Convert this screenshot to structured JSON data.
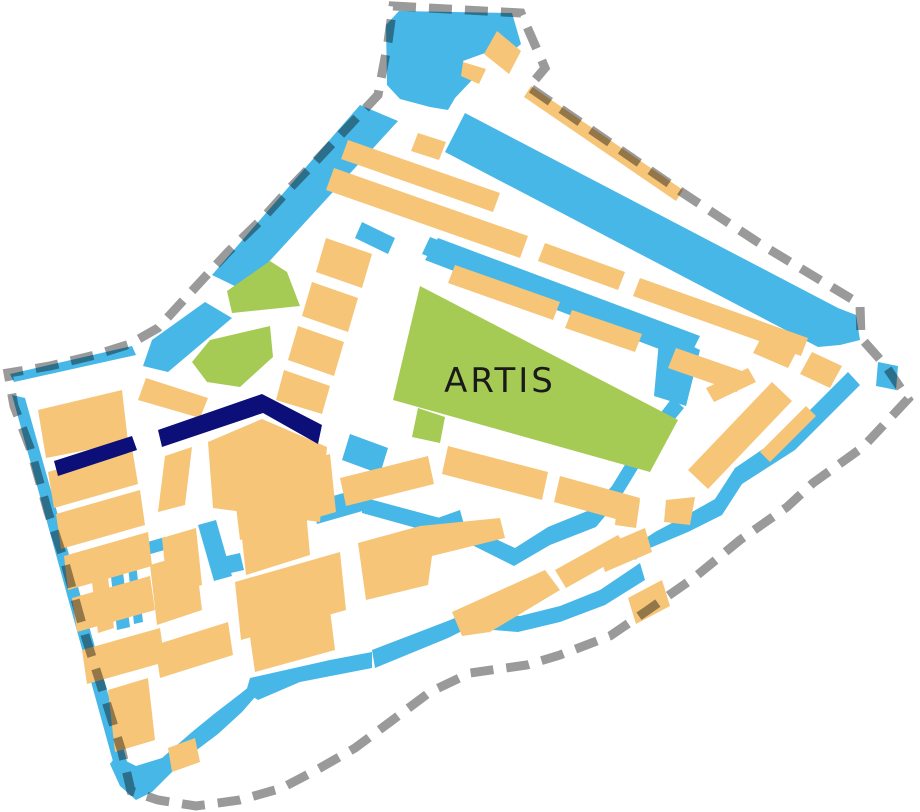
{
  "map": {
    "title_label": "ARTIS",
    "label_position": {
      "x": 500,
      "y": 392
    },
    "palette": {
      "background": "#FFFFFF",
      "water": "#47B7E7",
      "block": "#F6C577",
      "park": "#A6CB55",
      "highlight": "#0C0F78",
      "boundary": "#9A9A9A",
      "label": "#1A1A1A"
    },
    "boundary": {
      "name": "district-boundary",
      "stroke_width": 9,
      "dash": "23 13",
      "path": "M393,6 L521,13 L545,68 L529,87 L683,193 L762,245 L860,304 L861,338 L885,365 L908,399 L863,447 L813,483 L787,507 L740,540 L695,577 L648,610 L610,636 L560,655 L527,665 L470,673 L430,692 L390,722 L355,748 L320,768 L282,788 L240,800 L196,806 L158,800 L131,791 L122,752 L104,695 L85,635 L65,563 L48,512 L30,448 L14,406 L8,373 L50,366 L95,355 L130,344 L158,328 L180,304 L204,278 L228,252 L262,219 L292,186 L315,162 L348,127 L378,95 L388,42 Z"
    },
    "shapes": [
      {
        "name": "harbor-water",
        "type": "water",
        "points": "399,11 512,13 521,44 501,61 485,53 463,61 472,80 455,98 448,110 430,107 400,99 387,85 386,25"
      },
      {
        "name": "nw-canal-upper",
        "type": "water",
        "points": "360,105 398,121 243,290 212,275"
      },
      {
        "name": "nw-canal-lower",
        "type": "water",
        "points": "205,302 232,318 168,372 143,366 152,340"
      },
      {
        "name": "west-boundary-canal-top",
        "type": "water",
        "points": "10,374 132,346 136,355 14,382"
      },
      {
        "name": "west-boundary-canal",
        "type": "water",
        "points": "12,395 25,398 130,772 117,776"
      },
      {
        "name": "southwest-canal-bend",
        "type": "water",
        "points": "116,756 136,766 162,758 192,732 214,714 240,694 250,686 256,696 242,712 218,734 194,752 170,774 152,792 136,800 120,786 110,764"
      },
      {
        "name": "entrepotdok-canal",
        "type": "water",
        "points": "465,113 838,308 856,315 860,340 840,345 818,347 445,152"
      },
      {
        "name": "boundary-water-patch",
        "type": "water",
        "points": "878,362 898,366 896,390 876,386"
      },
      {
        "name": "middle-canal",
        "type": "water",
        "points": "438,238 700,336 688,360 425,260"
      },
      {
        "name": "artis-east-canal",
        "type": "water",
        "points": "660,330 700,350 686,406 654,396"
      },
      {
        "name": "artis-south-canal",
        "type": "water",
        "points": "672,398 640,440 612,486 590,510 548,527 515,548 470,527 440,518 362,497 362,513 438,534 468,543 514,566 550,545 596,527 620,498 648,452 684,408"
      },
      {
        "name": "southeast-boundary-canal",
        "type": "water",
        "points": "860,385 795,450 742,484 722,515 688,532 650,548 635,560 640,542 655,532 685,516 715,499 735,468 788,432 848,372"
      },
      {
        "name": "south-canal",
        "type": "water",
        "points": "372,650 445,622 470,612 520,616 560,606 600,590 640,563 645,580 605,605 560,622 518,632 468,628 448,638 375,668"
      },
      {
        "name": "south-canal-west",
        "type": "water",
        "points": "246,692 250,678 330,660 372,652 372,668 300,682 258,700"
      },
      {
        "name": "canal-bit-1",
        "type": "water",
        "points": "362,222 395,238 388,254 355,238"
      },
      {
        "name": "canal-bit-2",
        "type": "water",
        "points": "430,237 456,247 448,264 422,254"
      },
      {
        "name": "canal-bit-3",
        "type": "water",
        "points": "350,434 388,448 380,474 342,460"
      },
      {
        "name": "canal-bit-4",
        "type": "water",
        "points": "198,525 216,520 232,576 214,581"
      },
      {
        "name": "canal-bit-5",
        "type": "water",
        "points": "110,568 122,565 130,627 117,630"
      },
      {
        "name": "canal-bit-6",
        "type": "water",
        "points": "128,566 136,564 143,622 134,624"
      },
      {
        "name": "canal-bit-7",
        "type": "water",
        "points": "85,560 165,537 168,549 88,572"
      },
      {
        "name": "canal-bit-8",
        "type": "water",
        "points": "296,578 324,570 330,592 302,600"
      },
      {
        "name": "canal-bit-9",
        "type": "water",
        "points": "312,502 368,486 373,508 317,524"
      },
      {
        "name": "canal-bit-10",
        "type": "water",
        "points": "432,520 460,510 466,532 438,542"
      },
      {
        "name": "canal-bit-11",
        "type": "water",
        "points": "275,630 328,612 333,635 280,652"
      },
      {
        "name": "canal-bit-12",
        "type": "water",
        "points": "218,558 240,553 244,570 222,575"
      },
      {
        "name": "harbor-island-1",
        "type": "block",
        "points": "497,31 521,51 509,74 484,54"
      },
      {
        "name": "harbor-island-2",
        "type": "block",
        "points": "463,62 486,69 479,84 461,76"
      },
      {
        "name": "boundary-strip",
        "type": "block",
        "points": "531,86 683,190 676,201 524,97"
      },
      {
        "name": "ne-strip-1",
        "type": "block",
        "points": "348,140 500,193 493,212 341,159"
      },
      {
        "name": "ne-strip-1b",
        "type": "block",
        "points": "418,133 446,142 439,160 411,151"
      },
      {
        "name": "ne-strip-2",
        "type": "block",
        "points": "334,168 528,236 520,258 326,190"
      },
      {
        "name": "ne-strip-2e",
        "type": "block",
        "points": "545,243 625,272 618,290 538,261"
      },
      {
        "name": "ne-strip-2f",
        "type": "block",
        "points": "640,278 808,338 801,356 633,296"
      },
      {
        "name": "ne-strip-3a",
        "type": "block",
        "points": "455,265 560,302 553,320 448,283"
      },
      {
        "name": "ne-strip-3b",
        "type": "block",
        "points": "572,310 642,334 635,352 565,328"
      },
      {
        "name": "east-block-1",
        "type": "block",
        "points": "676,348 745,372 737,392 668,368"
      },
      {
        "name": "east-block-2",
        "type": "block",
        "points": "765,330 800,345 788,368 753,353"
      },
      {
        "name": "east-block-3",
        "type": "block",
        "points": "812,352 842,366 830,388 800,374"
      },
      {
        "name": "se-block-1",
        "type": "block",
        "points": "706,388 748,368 756,382 714,402"
      },
      {
        "name": "se-block-2",
        "type": "block",
        "points": "688,470 772,382 792,401 708,489"
      },
      {
        "name": "se-block-3",
        "type": "block",
        "points": "760,452 806,406 816,416 770,462"
      },
      {
        "name": "se-block-4",
        "type": "block",
        "points": "666,500 695,497 690,525 664,522"
      },
      {
        "name": "se-block-5",
        "type": "block",
        "points": "617,505 640,500 636,528 615,525"
      },
      {
        "name": "west-col-1",
        "type": "block",
        "points": "326,238 372,254 362,288 316,272"
      },
      {
        "name": "west-col-2",
        "type": "block",
        "points": "312,282 358,298 348,332 302,316"
      },
      {
        "name": "west-col-3",
        "type": "block",
        "points": "298,326 344,342 334,376 288,360"
      },
      {
        "name": "west-col-4",
        "type": "block",
        "points": "284,370 330,386 322,414 276,400"
      },
      {
        "name": "left-wedge",
        "type": "block",
        "points": "146,378 208,398 200,418 138,400"
      },
      {
        "name": "left-big-block",
        "type": "block",
        "points": "38,410 122,390 128,442 46,458"
      },
      {
        "name": "sw-a1",
        "type": "block",
        "points": "48,472 132,448 138,484 54,508"
      },
      {
        "name": "sw-a2",
        "type": "block",
        "points": "165,456 192,447 185,505 158,512"
      },
      {
        "name": "sw-a3",
        "type": "block",
        "points": "208,442 262,419 327,447 320,522 213,508"
      },
      {
        "name": "sw-b1",
        "type": "block",
        "points": "56,514 140,490 145,525 61,549"
      },
      {
        "name": "sw-c1",
        "type": "block",
        "points": "64,556 148,532 152,566 68,590"
      },
      {
        "name": "sw-c2",
        "type": "block",
        "points": "162,538 196,528 202,585 168,595"
      },
      {
        "name": "sw-c3",
        "type": "block",
        "points": "240,520 305,500 310,555 246,575"
      },
      {
        "name": "sw-d1",
        "type": "block",
        "points": "72,598 150,576 155,610 77,632"
      },
      {
        "name": "sw-d2",
        "type": "block",
        "points": "92,582 108,577 114,628 98,633"
      },
      {
        "name": "sw-d3",
        "type": "block",
        "points": "150,565 195,552 202,610 157,625"
      },
      {
        "name": "sw-d4",
        "type": "block",
        "points": "235,582 340,552 346,610 241,640"
      },
      {
        "name": "sw-e1",
        "type": "block",
        "points": "82,650 160,628 165,662 87,684"
      },
      {
        "name": "sw-e2",
        "type": "block",
        "points": "155,645 228,622 233,655 160,678"
      },
      {
        "name": "sw-e3",
        "type": "block",
        "points": "250,637 330,610 335,650 255,672"
      },
      {
        "name": "sw-f1",
        "type": "block",
        "points": "108,690 148,678 155,740 115,752"
      },
      {
        "name": "sw-f3",
        "type": "block",
        "points": "168,748 195,738 200,762 172,772"
      },
      {
        "name": "center-k1",
        "type": "block",
        "points": "233,482 330,454 336,512 240,540"
      },
      {
        "name": "center-t1",
        "type": "block",
        "points": "340,478 428,456 434,484 346,506"
      },
      {
        "name": "center-t2",
        "type": "block",
        "points": "448,446 548,472 542,500 442,474"
      },
      {
        "name": "center-t3",
        "type": "block",
        "points": "560,476 640,498 634,524 554,502"
      },
      {
        "name": "center-m1",
        "type": "block",
        "points": "358,543 420,526 500,518 505,538 432,556 428,585 366,600"
      },
      {
        "name": "center-m2",
        "type": "block",
        "points": "452,612 545,570 560,590 490,632 462,636"
      },
      {
        "name": "center-m3",
        "type": "block",
        "points": "555,570 618,535 630,552 566,588"
      },
      {
        "name": "center-m5",
        "type": "block",
        "points": "628,598 662,580 670,606 636,624"
      },
      {
        "name": "center-m6",
        "type": "block",
        "points": "598,548 645,528 652,552 605,572"
      },
      {
        "name": "artis-park",
        "type": "park",
        "points": "420,286 678,420 650,472 393,400"
      },
      {
        "name": "park-upper-west",
        "type": "park",
        "points": "270,261 287,272 300,306 232,313 227,291"
      },
      {
        "name": "park-lower-west",
        "type": "park",
        "points": "270,326 273,357 240,387 207,382 192,362 210,340"
      },
      {
        "name": "park-small-square",
        "type": "park",
        "points": "418,408 445,417 440,443 412,437"
      },
      {
        "name": "highlight-band-west",
        "type": "highlight",
        "points": "54,461 132,436 137,450 58,476"
      },
      {
        "name": "highlight-band-chevron",
        "type": "highlight",
        "points": "158,430 262,394 322,425 318,444 263,413 162,447"
      }
    ]
  }
}
